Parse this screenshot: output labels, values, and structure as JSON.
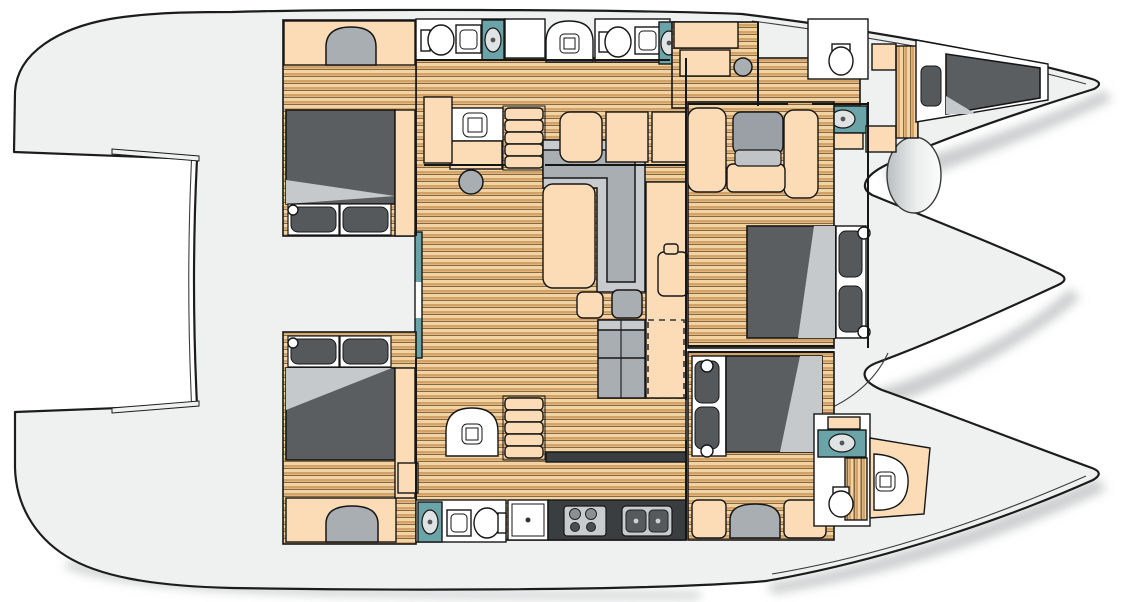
{
  "meta": {
    "title": "Catamaran yacht interior layout — top-view floor plan",
    "figure_type": "floor-plan",
    "visible_text": []
  },
  "palette": {
    "background": "#ffffff",
    "deck": "#eff1f1",
    "outline": "#1c1c1c",
    "shadow": "#969c9d",
    "wood_light": "#f2d4a4",
    "wood_mid": "#d3a269",
    "wood_line": "#7d5c36",
    "cabinet": "#fbdcb6",
    "fixture_white": "#ffffff",
    "sink_counter": "#6ba4a8",
    "basin": "#dfe3e4",
    "mattress": "#5b5e61",
    "blanket": "#c6c9cb",
    "pillow": "#56595c",
    "sofa": "#a9aeb3",
    "sofa_light": "#c8cbce",
    "counter_dark": "#3b3e40"
  },
  "vessel": {
    "orientation": "bow-right",
    "hulls": [
      "port-hull-top",
      "starboard-hull-bottom"
    ],
    "deck_areas": [
      "aft-deck-left",
      "transom-notch",
      "bridgedeck-salon",
      "foredeck-pod",
      "two-bow-tips"
    ],
    "rooms": [
      {
        "id": "port-aft-cabin",
        "furniture": [
          "double-bed",
          "pillows",
          "bench-seat",
          "cabinets"
        ]
      },
      {
        "id": "port-aft-bathroom",
        "furniture": [
          "toilet",
          "shower-tray",
          "washbasin"
        ]
      },
      {
        "id": "port-midship-bathroom",
        "furniture": [
          "shower-stall",
          "toilet",
          "shower-tray",
          "washbasin"
        ]
      },
      {
        "id": "port-corridor",
        "furniture": [
          "vanity-sink",
          "desk",
          "stool",
          "companionway-stairs"
        ]
      },
      {
        "id": "port-forward-cabin",
        "furniture": [
          "vanity",
          "stool",
          "washbasin",
          "toilet",
          "v-berth-bed",
          "pillow"
        ]
      },
      {
        "id": "salon",
        "furniture": [
          "l-shaped-sofa",
          "coffee-table",
          "ottoman",
          "fridge-sideboard",
          "storage-column",
          "forward-benches",
          "sliding-door"
        ]
      },
      {
        "id": "galley",
        "furniture": [
          "dishwasher",
          "stove-4-burner",
          "double-sink",
          "dark-counter"
        ]
      },
      {
        "id": "owner-cabin-midship",
        "furniture": [
          "lounge-chair",
          "settees",
          "double-bed",
          "pillows",
          "portholes"
        ]
      },
      {
        "id": "starboard-mid-cabin",
        "furniture": [
          "double-bed",
          "pillows",
          "bench-seat",
          "portholes"
        ]
      },
      {
        "id": "starboard-forward-bathroom",
        "furniture": [
          "washbasin",
          "toilet",
          "shower-stall"
        ]
      },
      {
        "id": "starboard-aft-cabin",
        "furniture": [
          "double-bed",
          "pillows",
          "bench-seat"
        ]
      },
      {
        "id": "starboard-aft-bathroom",
        "furniture": [
          "washbasin",
          "shower-tray",
          "toilet"
        ]
      },
      {
        "id": "starboard-corridor",
        "furniture": [
          "companionway-stairs",
          "shower-stall"
        ]
      }
    ]
  }
}
